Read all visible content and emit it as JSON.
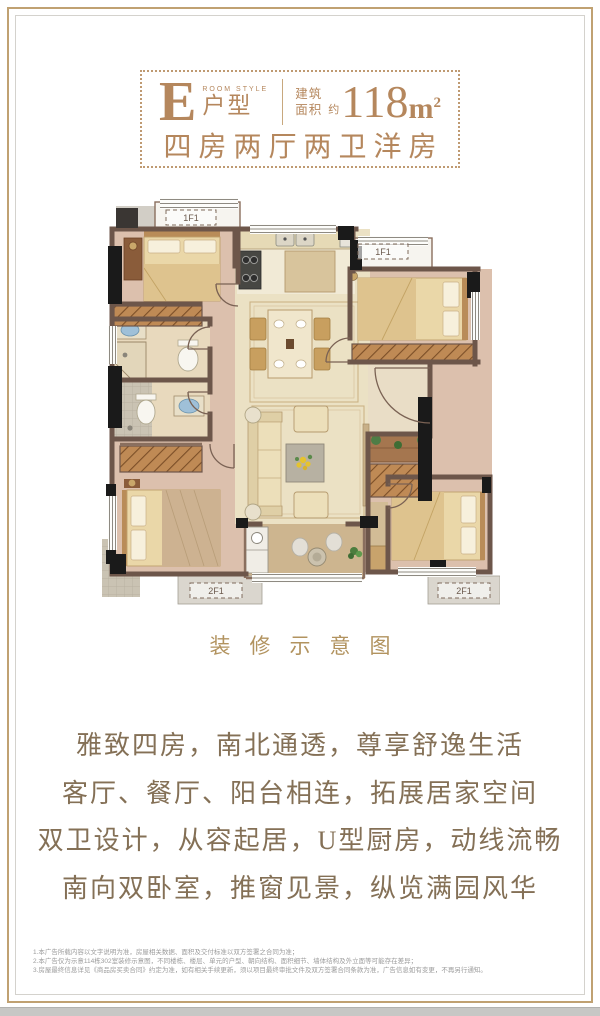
{
  "colors": {
    "accent": "#b5875d",
    "caption_gold": "#b2935f",
    "body_text": "#847056",
    "frame_gold": "#c0a172",
    "frame_gray": "#d4d2cd",
    "wall": "#6d564a",
    "floor_pink": "#dcc0ad",
    "floor_cream": "#ebe1c4",
    "floor_wood": "#cdb58f"
  },
  "header": {
    "letter": "E",
    "room_style": "ROOM STYLE",
    "type_label": "户型",
    "area_word_1": "建筑",
    "area_word_2": "面积",
    "approx": "约",
    "area_value": "118",
    "area_unit": "m",
    "area_sup": "2",
    "subtitle": "四房两厅两卫洋房"
  },
  "floorplan": {
    "ac_top_label": "1F1",
    "ac_bottom_label": "2F1"
  },
  "caption": "装修示意图",
  "description": {
    "lines": [
      "雅致四房，南北通透，尊享舒逸生活",
      "客厅、餐厅、阳台相连，拓展居家空间",
      "双卫设计，从容起居，U型厨房，动线流畅",
      "南向双卧室，推窗见景，纵览满园风华"
    ]
  },
  "disclaimer": {
    "lines": [
      "1.本广告所载内容以文字说明为准，房屋相关数据、面积及交付标准以双方签署之合同为准；",
      "2.本广告仅为示意114栋302室装修示意图，不同楼栋、楼层、单元的户型、朝向结构、面积细节、墙体结构及外立面等可能存在差异；",
      "3.房屋最终信息详见《商品房买卖合同》约定为准，如有相关手续更新，须以项目最终审批文件及双方签署合同条款为准，广告信息如有变更，不再另行通知。"
    ]
  }
}
